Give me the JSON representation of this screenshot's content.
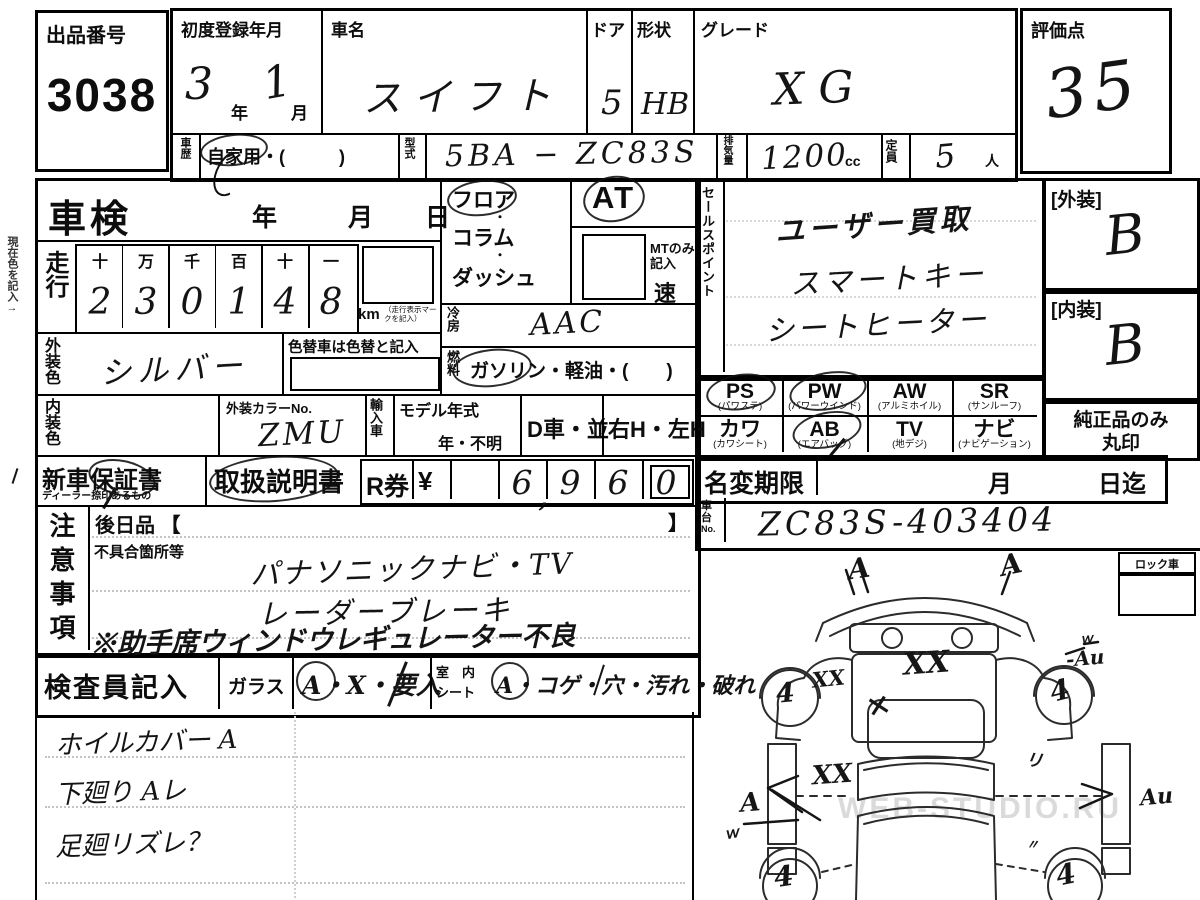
{
  "sheet": {
    "lot": {
      "label": "出品番号",
      "value": "3038"
    },
    "score": {
      "label": "評価点",
      "value": "35"
    },
    "reg": {
      "label": "初度登録年月",
      "year": "3",
      "year_unit": "年",
      "month": "1",
      "month_unit": "月"
    },
    "car": {
      "label": "車名",
      "value": "スイフト"
    },
    "doors": {
      "label": "ドア",
      "value": "5"
    },
    "shape": {
      "label": "形状",
      "value": "HB"
    },
    "grade": {
      "label": "グレード",
      "value": "XG"
    },
    "history": {
      "label": "車歴",
      "value": "自家用・(　　　)"
    },
    "model": {
      "label": "型式",
      "value": "5BA − ZC83S"
    },
    "disp": {
      "label": "排気量",
      "value": "1200",
      "unit": "cc"
    },
    "seats": {
      "label": "定員",
      "value": "5",
      "unit": "人"
    },
    "shaken": {
      "label": "車検",
      "year": "年",
      "month": "月",
      "day": "日"
    },
    "odo": {
      "label": "走行",
      "cols": [
        "十",
        "万",
        "千",
        "百",
        "十",
        "一"
      ],
      "digits": [
        "2",
        "3",
        "0",
        "1",
        "4",
        "8"
      ],
      "unit": "km",
      "note": "（走行表示マークを記入）"
    },
    "shift": {
      "floor": "フロア",
      "column": "コラム",
      "dash": "ダッシュ",
      "sep": "・",
      "at": "AT",
      "mt1": "MTのみ",
      "mt2": "記入",
      "speed": "速"
    },
    "ac": {
      "label": "冷房",
      "value": "AAC"
    },
    "fuel": {
      "label": "燃料",
      "value": "ガソリン・軽油・(　　)"
    },
    "ext_color": {
      "label": "外装色",
      "value": "シルバー",
      "note": "色替車は色替と記入"
    },
    "int_color": {
      "label": "内装色",
      "value": ""
    },
    "color_no": {
      "label": "外装カラーNo.",
      "value": "ZMU"
    },
    "import": {
      "label": "輸入車"
    },
    "model_year": {
      "label": "モデル年式",
      "value": "年・不明"
    },
    "d_car": "D車・並",
    "handle": "右H・左H",
    "warranty": {
      "label": "新車保証書",
      "sub": "ディーラー捺印あるもの"
    },
    "manual": {
      "label": "取扱説明書"
    },
    "ticket": {
      "label": "R券",
      "yen": "¥",
      "digits": [
        "",
        "6",
        "9",
        "6",
        "0"
      ],
      "comma": ",",
      "price": "6,960"
    },
    "sales": {
      "label": "セールスポイント",
      "lines": [
        "ユーザー買取",
        "スマートキー",
        "シートヒーター"
      ]
    },
    "equip": {
      "row1": [
        {
          "code": "PS",
          "name": "(パワステ)"
        },
        {
          "code": "PW",
          "name": "(パワーウインド)"
        },
        {
          "code": "AW",
          "name": "(アルミホイル)"
        },
        {
          "code": "SR",
          "name": "(サンルーフ)"
        }
      ],
      "row2": [
        {
          "code": "カワ",
          "name": "(カワシート)"
        },
        {
          "code": "AB",
          "name": "(エアバッグ)"
        },
        {
          "code": "TV",
          "name": "(地デジ)"
        },
        {
          "code": "ナビ",
          "name": "(ナビゲーション)"
        }
      ],
      "circled": [
        "PS",
        "PW",
        "AB"
      ]
    },
    "ext_grade": {
      "label": "[外装]",
      "value": "B"
    },
    "int_grade": {
      "label": "[内装]",
      "value": "B"
    },
    "genuine": {
      "line1": "純正品のみ",
      "line2": "丸印"
    },
    "rename": {
      "label": "名変期限",
      "month": "月",
      "day": "日迄"
    },
    "chassis": {
      "label1": "車台",
      "label2": "No.",
      "value": "ZC83S-403404"
    },
    "notes": {
      "label": "注意事項",
      "after": "後日品 【",
      "close": "】",
      "defect_label": "不具合箇所等",
      "lines": [
        "パナソニックナビ・TV",
        "レーダーブレーキ",
        "※助手席ウィンドウレギュレーター不良"
      ]
    },
    "inspector": {
      "label": "検査員記入",
      "glass_label": "ガラス",
      "glass_opts": "A・X・要入",
      "seat_label1": "室　内",
      "seat_label2": "シート",
      "seat_opts": "A・コゲ・穴・汚れ・破れ"
    },
    "inspector_notes": [
      "ホイルカバー A",
      "下廻り Aレ",
      "足廻リズレ？"
    ],
    "lock": {
      "label": "ロック車"
    },
    "margin_note": "現在色を記入→",
    "watermark": "WEB-STUDIO.RU"
  },
  "diagram": {
    "marks": [
      {
        "text": "A",
        "x": 848,
        "y": 552,
        "size": 28,
        "rot": -8
      },
      {
        "text": "A",
        "x": 1000,
        "y": 548,
        "size": 28,
        "rot": -12
      },
      {
        "text": "XX",
        "x": 903,
        "y": 646,
        "size": 30,
        "rot": -4
      },
      {
        "text": "XX",
        "x": 812,
        "y": 666,
        "size": 21,
        "rot": -6
      },
      {
        "text": "×",
        "x": 866,
        "y": 688,
        "size": 30,
        "rot": -12
      },
      {
        "text": "4",
        "x": 776,
        "y": 678,
        "size": 27,
        "rot": -5
      },
      {
        "text": "4",
        "x": 1050,
        "y": 674,
        "size": 28,
        "rot": -14
      },
      {
        "text": "ｗ",
        "x": 1080,
        "y": 628,
        "size": 13,
        "rot": -6
      },
      {
        "text": "-Au",
        "x": 1066,
        "y": 646,
        "size": 20,
        "rot": -5
      },
      {
        "text": "XX",
        "x": 812,
        "y": 760,
        "size": 26,
        "rot": -4
      },
      {
        "text": "リ",
        "x": 1026,
        "y": 746,
        "size": 17,
        "rot": 8
      },
      {
        "text": "A",
        "x": 740,
        "y": 788,
        "size": 26,
        "rot": -5
      },
      {
        "text": "Au",
        "x": 1140,
        "y": 784,
        "size": 22,
        "rot": -5
      },
      {
        "text": "ｗ",
        "x": 724,
        "y": 822,
        "size": 15,
        "rot": -10
      },
      {
        "text": "〃",
        "x": 1026,
        "y": 834,
        "size": 13,
        "rot": 0
      },
      {
        "text": "4",
        "x": 774,
        "y": 860,
        "size": 28,
        "rot": -8
      },
      {
        "text": "4",
        "x": 1056,
        "y": 858,
        "size": 28,
        "rot": -12
      }
    ]
  }
}
